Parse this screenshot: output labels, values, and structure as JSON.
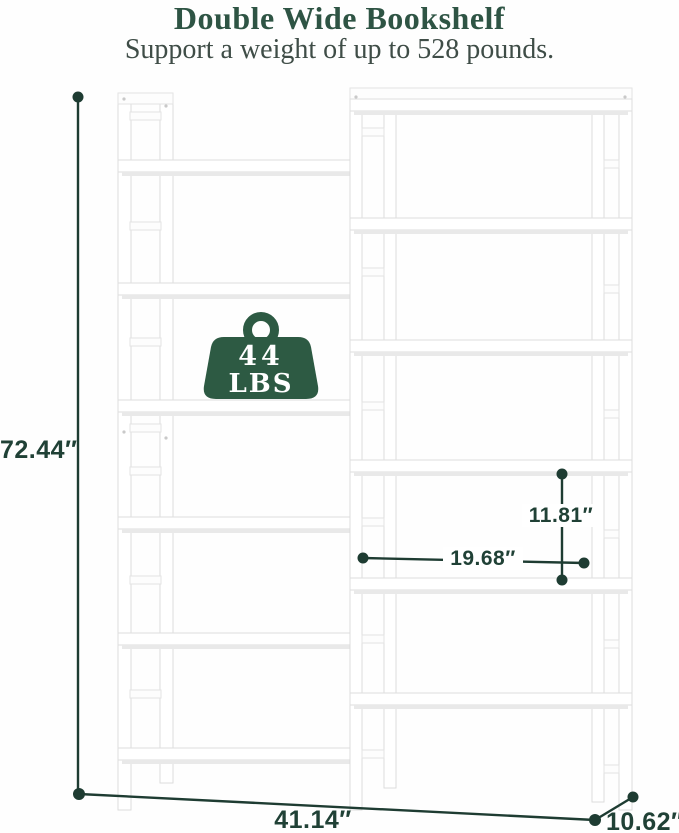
{
  "header": {
    "title": "Double Wide Bookshelf",
    "subtitle": "Support a weight of up to 528 pounds."
  },
  "weight_badge": {
    "value": "44",
    "unit": "LBS",
    "icon": "weight-icon"
  },
  "dimension_labels": {
    "overall_height": "72.44″",
    "overall_width": "41.14″",
    "depth": "10.62″",
    "shelf_height": "11.81″",
    "shelf_width": "19.68″"
  },
  "colors": {
    "title_green": "#2e5444",
    "subtitle_gray": "#3f4d47",
    "dimension_line_green": "#1e3c32",
    "badge_green": "#2d5a43",
    "shelf_white": "#ffffff",
    "shelf_edge_gray": "#dedede"
  }
}
